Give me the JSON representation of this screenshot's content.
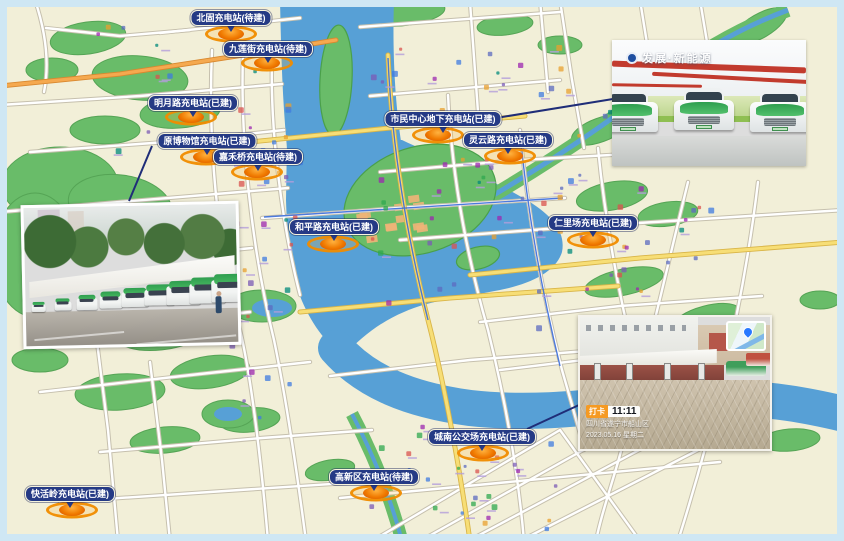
{
  "stations": [
    {
      "label": "北固充电站(待建)",
      "status": "待建",
      "marker_x": 231,
      "marker_y": 34,
      "label_x": 231,
      "label_y": 18
    },
    {
      "label": "九莲街充电站(待建)",
      "status": "待建",
      "marker_x": 267,
      "marker_y": 63,
      "label_x": 268,
      "label_y": 49
    },
    {
      "label": "明月路充电站(已建)",
      "status": "已建",
      "marker_x": 191,
      "marker_y": 117,
      "label_x": 193,
      "label_y": 103
    },
    {
      "label": "原博物馆充电站(已建)",
      "status": "已建",
      "marker_x": 206,
      "marker_y": 157,
      "label_x": 207,
      "label_y": 141
    },
    {
      "label": "嘉禾桥充电站(待建)",
      "status": "待建",
      "marker_x": 257,
      "marker_y": 172,
      "label_x": 258,
      "label_y": 157
    },
    {
      "label": "市民中心地下充电站(已建)",
      "status": "已建",
      "marker_x": 438,
      "marker_y": 135,
      "label_x": 443,
      "label_y": 119
    },
    {
      "label": "灵云路充电站(已建)",
      "status": "已建",
      "marker_x": 510,
      "marker_y": 156,
      "label_x": 508,
      "label_y": 140
    },
    {
      "label": "和平路充电站(已建)",
      "status": "已建",
      "marker_x": 333,
      "marker_y": 244,
      "label_x": 334,
      "label_y": 227
    },
    {
      "label": "仁里场充电站(已建)",
      "status": "已建",
      "marker_x": 593,
      "marker_y": 240,
      "label_x": 593,
      "label_y": 223
    },
    {
      "label": "城南公交场充电站(已建)",
      "status": "已建",
      "marker_x": 483,
      "marker_y": 453,
      "label_x": 482,
      "label_y": 437
    },
    {
      "label": "高新区充电站(待建)",
      "status": "待建",
      "marker_x": 376,
      "marker_y": 493,
      "label_x": 374,
      "label_y": 477
    },
    {
      "label": "快活岭充电站(已建)",
      "status": "已建",
      "marker_x": 72,
      "marker_y": 510,
      "label_x": 70,
      "label_y": 494
    }
  ],
  "photos": {
    "garage": {
      "watermark": "发展·新能源"
    },
    "depot": {
      "badge": "打卡",
      "time": "11:11",
      "address": "四川省遂宁市船山区",
      "date": "2023.05.16 星期二"
    }
  },
  "colors": {
    "label_bg": "#253a85",
    "marker_orange": "#f08c00",
    "river": "#57a0d6",
    "park": "#69bc69",
    "map_bg": "#f2efd8",
    "frame": "#cfe7f4",
    "leader_line": "#1f2d78",
    "road_yellow": "#f7de76"
  }
}
